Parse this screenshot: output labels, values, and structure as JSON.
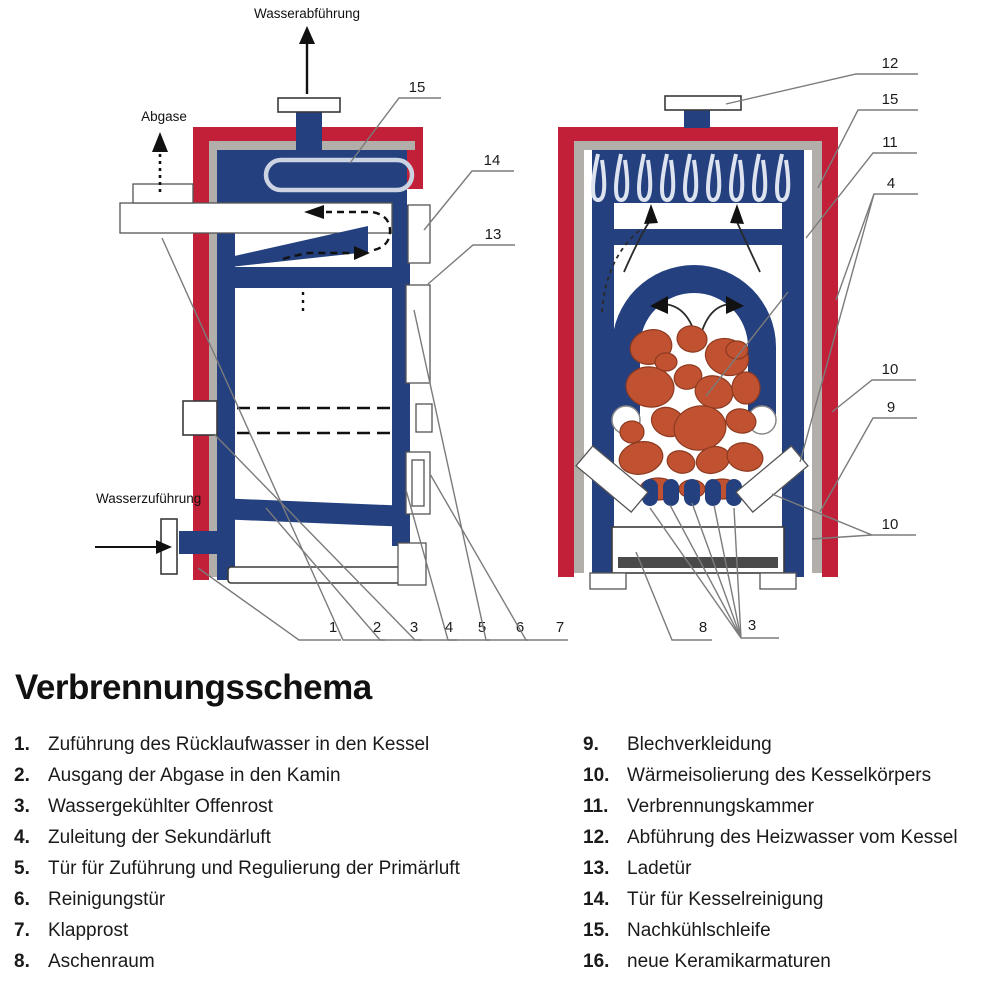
{
  "title": "Verbrennungsschema",
  "diagram": {
    "labels": {
      "water_out": "Wasserabführung",
      "flue_gas": "Abgase",
      "water_in": "Wasserzuführung"
    },
    "left_callouts": {
      "c15": "15",
      "c14": "14",
      "c13": "13",
      "c1": "1",
      "c2": "2",
      "c3": "3",
      "c4": "4",
      "c5": "5",
      "c6": "6",
      "c7": "7"
    },
    "right_callouts": {
      "c12": "12",
      "c15": "15",
      "c11": "11",
      "c4": "4",
      "c10a": "10",
      "c9": "9",
      "c10b": "10",
      "c8": "8",
      "c3": "3"
    },
    "colors": {
      "shell_red": "#c12038",
      "water_blue": "#24407f",
      "insulation_gray": "#b2afaa",
      "fuel_orange": "#c05232",
      "ash_dark": "#4a4a4a",
      "coil_light": "#dde3ef"
    }
  },
  "legend": {
    "left": [
      {
        "num": "1.",
        "text": "Zuführung des Rücklaufwasser in den Kessel"
      },
      {
        "num": "2.",
        "text": "Ausgang der Abgase in den Kamin"
      },
      {
        "num": "3.",
        "text": "Wassergekühlter Offenrost"
      },
      {
        "num": "4.",
        "text": "Zuleitung der Sekundärluft"
      },
      {
        "num": "5.",
        "text": "Tür für Zuführung und Regulierung der Primärluft"
      },
      {
        "num": "6.",
        "text": "Reinigungstür"
      },
      {
        "num": "7.",
        "text": "Klapprost"
      },
      {
        "num": "8.",
        "text": "Aschenraum"
      }
    ],
    "right": [
      {
        "num": "9.",
        "text": "Blechverkleidung"
      },
      {
        "num": "10.",
        "text": "Wärmeisolierung des Kesselkörpers"
      },
      {
        "num": "11.",
        "text": "Verbrennungskammer"
      },
      {
        "num": "12.",
        "text": "Abführung des Heizwasser vom Kessel"
      },
      {
        "num": "13.",
        "text": "Ladetür"
      },
      {
        "num": "14.",
        "text": "Tür für Kesselreinigung"
      },
      {
        "num": "15.",
        "text": "Nachkühlschleife"
      },
      {
        "num": "16.",
        "text": "neue Keramikarmaturen"
      }
    ]
  }
}
